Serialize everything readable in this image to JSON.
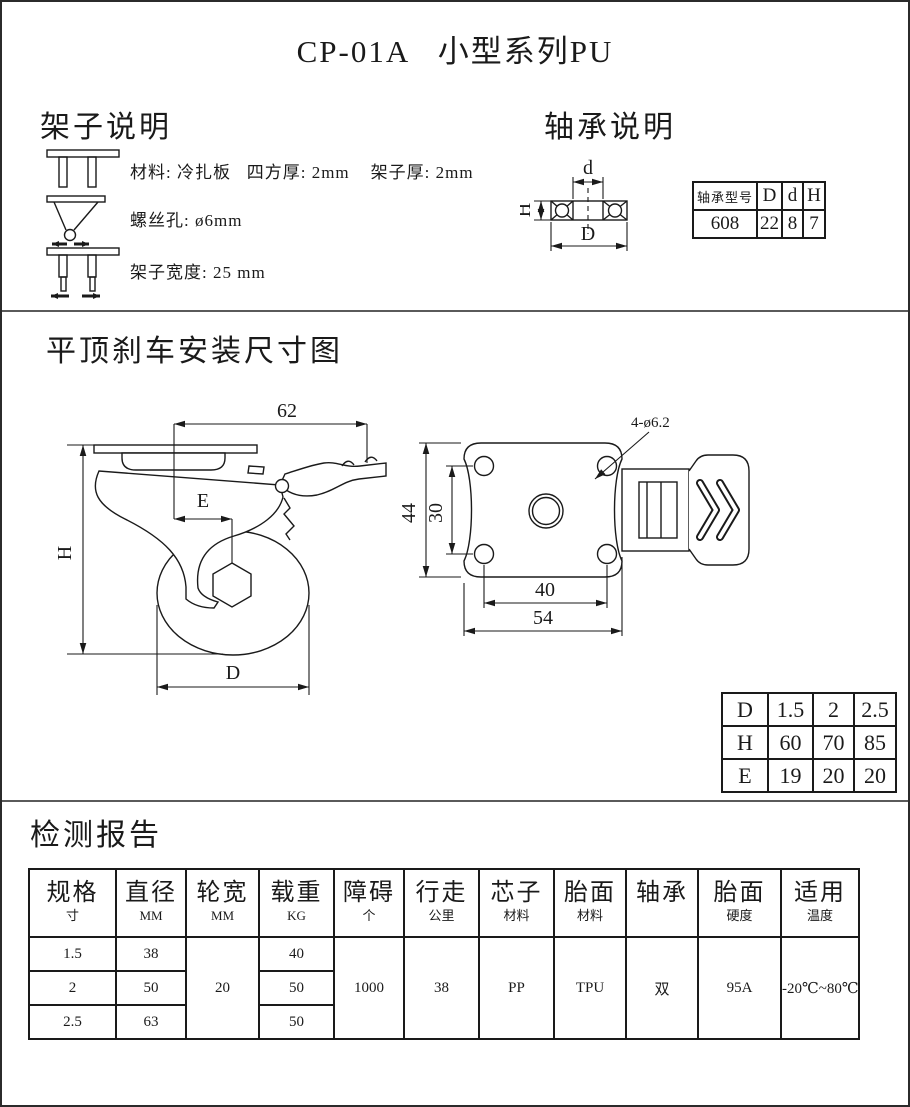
{
  "title": "CP-01A   小型系列PU",
  "frame_section": {
    "heading": "架子说明",
    "items": [
      {
        "icon": "bracket-short-icon",
        "text": "材料: 冷扎板   四方厚: 2mm    架子厚: 2mm"
      },
      {
        "icon": "screw-funnel-icon",
        "text": "螺丝孔: ø6mm"
      },
      {
        "icon": "bracket-long-icon",
        "text": "架子宽度: 25 mm"
      }
    ]
  },
  "bearing_section": {
    "heading": "轴承说明",
    "diagram_labels": {
      "d": "d",
      "D": "D",
      "H": "H"
    },
    "table": {
      "headers": [
        "轴承型号",
        "D",
        "d",
        "H"
      ],
      "values": [
        "608",
        "22",
        "8",
        "7"
      ]
    }
  },
  "drawing_section": {
    "heading": "平顶刹车安装尺寸图",
    "side_view": {
      "dim_top": "62",
      "dim_height": "H",
      "dim_offset": "E",
      "dim_diameter": "D"
    },
    "top_view": {
      "hole_note": "4-ø6.2",
      "dim_outer_v": "44",
      "dim_inner_v": "30",
      "dim_inner_h": "40",
      "dim_outer_h": "54"
    },
    "dims_table": {
      "rows": [
        [
          "D",
          "1.5",
          "2",
          "2.5"
        ],
        [
          "H",
          "60",
          "70",
          "85"
        ],
        [
          "E",
          "19",
          "20",
          "20"
        ]
      ]
    }
  },
  "report_section": {
    "heading": "检测报告",
    "table": {
      "columns": [
        {
          "label": "规格",
          "sub": "寸"
        },
        {
          "label": "直径",
          "sub": "MM"
        },
        {
          "label": "轮宽",
          "sub": "MM"
        },
        {
          "label": "载重",
          "sub": "KG"
        },
        {
          "label": "障碍",
          "sub": "个"
        },
        {
          "label": "行走",
          "sub": "公里"
        },
        {
          "label": "芯子",
          "sub": "材料"
        },
        {
          "label": "胎面",
          "sub": "材料"
        },
        {
          "label": "轴承",
          "sub": ""
        },
        {
          "label": "胎面",
          "sub": "硬度"
        },
        {
          "label": "适用",
          "sub": "温度"
        }
      ],
      "spec_rows": [
        {
          "size": "1.5",
          "diameter": "38",
          "load": "40"
        },
        {
          "size": "2",
          "diameter": "50",
          "load": "50"
        },
        {
          "size": "2.5",
          "diameter": "63",
          "load": "50"
        }
      ],
      "merged": {
        "wheel_width": "20",
        "obstacles": "1000",
        "distance": "38",
        "core_material": "PP",
        "tread_material": "TPU",
        "bearing": "双",
        "hardness": "95A",
        "temperature": "-20℃~80℃"
      }
    }
  }
}
